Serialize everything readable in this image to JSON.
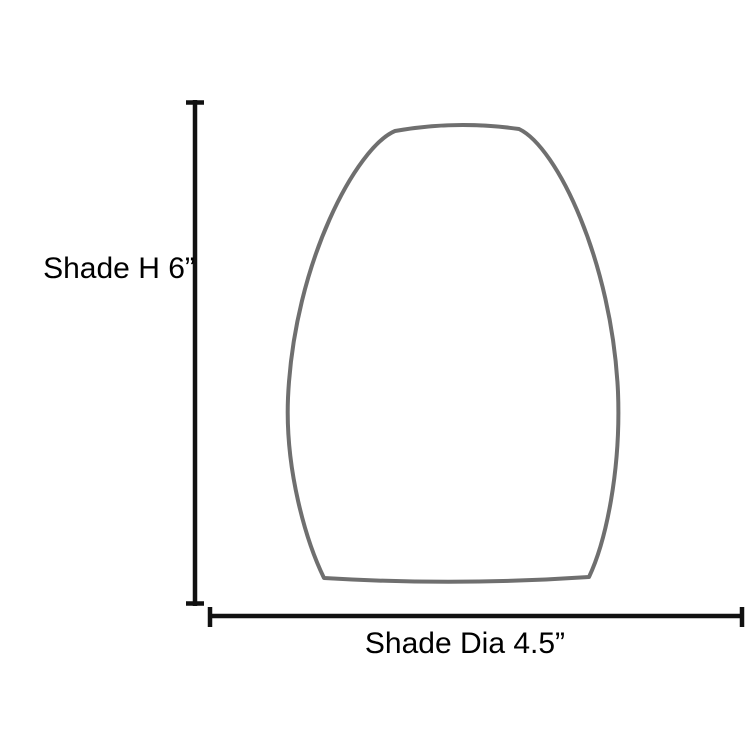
{
  "diagram": {
    "title": "lamp-shade-dimension-diagram",
    "height_label": "Shade H 6”",
    "diameter_label": "Shade Dia 4.5”",
    "colors": {
      "background": "#ffffff",
      "shade_outline": "#6f6f6f",
      "dimension_line": "#111111",
      "label_text": "#000000"
    }
  }
}
